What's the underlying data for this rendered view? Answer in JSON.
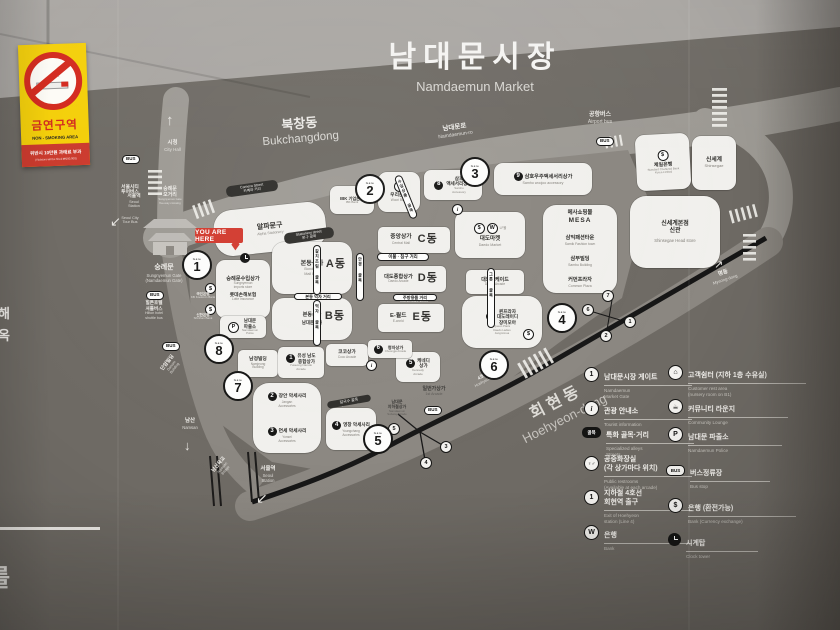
{
  "sign": {
    "no_smoking": {
      "title_ko": "금연구역",
      "title_en": "NON - SMOKING AREA",
      "penalty": "위반시 10만원 과태료 부과",
      "penalty_sub": "(Violators will be fined ₩100,000)"
    },
    "title_ko": "남대문시장",
    "title_en": "Namdaemun Market"
  },
  "icons": {
    "dollar": "$",
    "bank_w": "W",
    "info": "i",
    "police": "P",
    "restroom": "♀♂",
    "house": "⌂",
    "lounge": "☕",
    "alley": "골목",
    "up_arrow": "↑",
    "down_arrow": "↓",
    "ne_arrow": "↗",
    "sw_arrow": "↙"
  },
  "streets": {
    "bukchangdong_ko": "북창동",
    "bukchangdong_en": "Bukchangdong",
    "namdaemunro_ko": "남대문로",
    "namdaemunro_en": "Namdaemun-ro",
    "hoehyeon_ko": "회현동",
    "hoehyeon_en": "Hoehyeon-dong",
    "myeongdong_ko": "명동",
    "myeongdong_en": "Myeong-dong",
    "line4_ko": "4호선 회현역",
    "line4_en": "Hoehyeon St. (Line 4)",
    "city_hall_ko": "시청",
    "city_hall_en": "City Hall",
    "airport_ko": "공항버스",
    "airport_en": "Airport bus",
    "city_tour_ko": "서울시티\n투어버스",
    "city_tour_en": "Seoul City\nTour Bus",
    "seoul_station_ko": "서울역",
    "seoul_station_en": "Seoul\nStation",
    "crossing_ko": "숭례문\n오거리",
    "crossing_en": "Sungnyemun Gate\nfive-way crossing",
    "gate_ko": "숭례문",
    "gate_en": "Sungnyemun Gate\n(Namdaemun Gate)",
    "shuttle_ko": "힐튼호텔\n셔틀버스",
    "shuttle_en": "Hilton hotel\nshuttle bus",
    "danam_ko": "단암빌딩",
    "danam_en": "Danam\nBuilding",
    "namsan_ko": "남산",
    "namsan_en": "Namsan",
    "bridge_ko": "남산육교",
    "bridge_en": "Namsan\nBridge",
    "bus": "BUS",
    "you_are_here": "YOU ARE HERE",
    "gate_word": "Gate"
  },
  "alleys": {
    "camera_en": "Camera Street",
    "camera_ko": "카메라 거리",
    "stationery_en": "Stationery street",
    "stationery_ko": "문구 골목",
    "bedding_en": "Bedding street",
    "bedding_ko": "이불 · 침구 거리",
    "kitchen_en": "Kitchenware street",
    "kitchen_ko": "주방용품 거리",
    "kalguksu_en": "Kalguksu alley",
    "kalguksu_ko": "칼국수 골목",
    "bondong_food": "본동 먹자 거리",
    "v1": "갈치조림 골목",
    "v2": "먹자 골목",
    "v3": "안경 골목",
    "v4": "그릇 골목",
    "v5": "수입상품 골목"
  },
  "buildings": {
    "alpha": {
      "ko": "알파문구",
      "en": "Alpha Stationery"
    },
    "imports": {
      "ko": "숭례문수입상가",
      "en": "Sungnyemun\nimports store"
    },
    "lotte": {
      "ko": "롯데손해보험",
      "en": "Lotte Insurance"
    },
    "kookmin": {
      "ko": "국민은행",
      "en": "KB Kookmin Bank"
    },
    "shinhan": {
      "ko": "신한은행",
      "en": "Shinhan Bank"
    },
    "police": {
      "ko": "남대문\n파출소",
      "en": "Namdaemun\nPolice"
    },
    "namjeong": {
      "ko": "남정빌딩",
      "en": "Namjeong\nBuilding"
    },
    "yuseong": {
      "num": "1",
      "ko": "유성 남도\n종합상가",
      "en": "Yuseong Namdo\nArcade"
    },
    "coco": {
      "ko": "코코상가",
      "en": "Coco Arcade"
    },
    "jangan": {
      "num": "2",
      "ko": "장안 악세사리",
      "en": "Jangan\nAccessories"
    },
    "yonsei": {
      "num": "3",
      "ko": "연세 악세사리",
      "en": "Yonsei\nAccessories"
    },
    "youngchang": {
      "num": "4",
      "ko": "영창 악세사리",
      "en": "Youngchang\nAccessories"
    },
    "kennedy": {
      "num": "5",
      "ko": "케네디\n상가",
      "en": "Kennedy\nArcade"
    },
    "cheongja": {
      "num": "6",
      "ko": "청자상가",
      "en": "Cheongja Arcade"
    },
    "queen": {
      "num": "7",
      "ko": "퀸프라자\n대도레이디\n장미모아",
      "en": "Queen Plaza\nDaedo Ladies\nJangmimoa"
    },
    "samho": {
      "num": "8",
      "ko": "삼호\n액세서리상가",
      "en": "Samho\nAccessory"
    },
    "samho_woojoo": {
      "num": "9",
      "ko": "삼호우주액세서리상가",
      "en": "Samho woojoo accessory"
    },
    "bondong": {
      "ko": "본동상가",
      "en": "Bondong\nMall Bldg",
      "block": "A동"
    },
    "bondong_b": {
      "ko": "본동상가",
      "ko2": "남대문상가",
      "block": "B동"
    },
    "central": {
      "ko": "중앙상가",
      "en": "Central Mall",
      "block": "C동"
    },
    "daedo_general": {
      "ko": "대도종합상가",
      "en": "Daedo Arcade",
      "block": "D동"
    },
    "eworld": {
      "ko": "E-월드",
      "en": "E-world",
      "block": "E동"
    },
    "daedo_market": {
      "ko": "대도마켓",
      "en": "Daedo Market",
      "extra": "LF몰"
    },
    "daedo_arcade": {
      "ko": "대도아케이드",
      "en": "Daedo Arcade"
    },
    "first": {
      "ko": "일번가상가",
      "en": "1st Arcade"
    },
    "subway_arcade": {
      "ko": "남대문\n지하철상가",
      "en": "Namdaemun\nSubway Arcade"
    },
    "mesa": {
      "ko": "메사쇼핑몰",
      "en": "MESA"
    },
    "samik": {
      "ko": "삼익패션타운",
      "en": "Samik Fashion town"
    },
    "sambu": {
      "ko": "삼부빌딩",
      "en": "Sambu Building"
    },
    "common": {
      "ko": "커먼프라자",
      "en": "Common Plaza"
    },
    "woori": {
      "ko": "우리은행",
      "en": "Woori Bank"
    },
    "ibk": {
      "ko": "IBK 기업은행",
      "en": "IBK Bank"
    },
    "standard": {
      "ko": "제일은행",
      "en": "Standard Chartered Bank\nKorea Limited"
    },
    "shinsegae": {
      "ko": "신세계",
      "en": "Shinsegae"
    },
    "shinsegae_head": {
      "ko": "신세계본점\n신관",
      "en": "Shinsegae Head store"
    }
  },
  "gates": [
    "1",
    "2",
    "3",
    "4",
    "5",
    "6",
    "7",
    "8"
  ],
  "exits": {
    "e1": "1",
    "e2": "2",
    "e3": "3",
    "e4": "4",
    "e5": "5",
    "e6": "6",
    "e7": "7"
  },
  "legend": {
    "left": [
      {
        "ko": "남대문시장 게이트",
        "en": "Namdaemun\nMarket Gate",
        "icon": "1"
      },
      {
        "ko": "관광 안내소",
        "en": "Tourist information",
        "icon": "i"
      },
      {
        "ko": "특화 골목·거리",
        "en": "Specialized alleys\nStreets",
        "icon": "골목"
      },
      {
        "ko": "공중화장실\n(각 상가마다 위치)",
        "en": "Public restrooms\n(Available at each arcade)",
        "icon": "♀♂"
      },
      {
        "ko": "지하철 4호선\n회현역 출구",
        "en": "Exit of Hoehyeon\nstation (Line 4)",
        "icon": "1"
      },
      {
        "ko": "은행",
        "en": "Bank",
        "icon": "W"
      }
    ],
    "right": [
      {
        "ko": "고객쉼터 (지하 1층 수유실)",
        "en": "Customer rest area\n(nursery room on B1)",
        "icon": "⌂"
      },
      {
        "ko": "커뮤니티 라운지",
        "en": "Community Lounge",
        "icon": "☕"
      },
      {
        "ko": "남대문 파출소",
        "en": "Namdaemun Police",
        "icon": "P"
      },
      {
        "ko": "버스정류장",
        "en": "Bus stop",
        "icon": "BUS"
      },
      {
        "ko": "은행 (환전가능)",
        "en": "Bank (Currency exchange)",
        "icon": "$"
      },
      {
        "ko": "시계탑",
        "en": "Clock tower",
        "icon": "clock"
      }
    ]
  },
  "fragments": {
    "f1": "롯해",
    "f2": "면옥",
    "f3": "를"
  },
  "colors": {
    "accent_red": "#d23a2e",
    "sign_yellow": "#f4cf08",
    "board": "#6e6a64",
    "building": "#f1f0ed",
    "road": "#9d9a94",
    "block": "#8b8781",
    "subway_line": "#161616"
  }
}
